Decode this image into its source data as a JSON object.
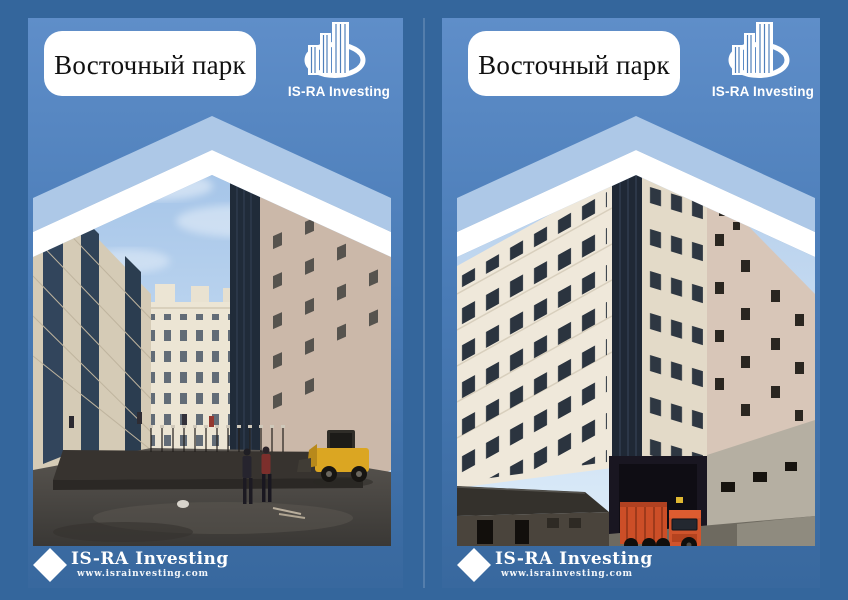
{
  "page": {
    "title": "Восточный парк"
  },
  "brand": {
    "name": "IS-RA Investing",
    "logo_icon": "buildings-in-ellipse-icon"
  },
  "footer": {
    "brand": "IS-RA Investing",
    "url": "www.israinvesting.com",
    "icon": "diamond-icon"
  },
  "photos": {
    "left_subject": "construction courtyard between residential buildings with workers and yellow loader",
    "right_subject": "residential building facade corner with orange dump truck"
  },
  "colors": {
    "outer_bg": "#34669c",
    "panel_top": "#5f8ec9",
    "panel_mid": "#497bb6",
    "panel_bottom": "#38689e",
    "pale_chevron": "#adc8e7",
    "white": "#ffffff",
    "title_text": "#111111",
    "seam": "rgba(255,255,255,0.16)"
  }
}
